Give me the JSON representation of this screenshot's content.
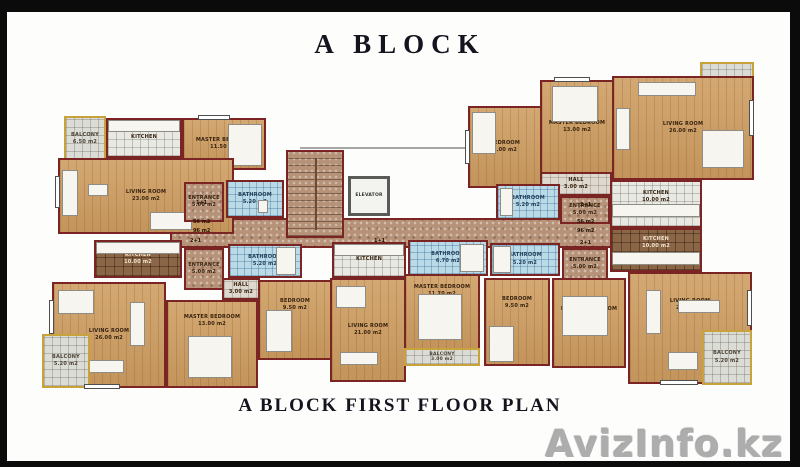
{
  "page": {
    "title": "A BLOCK",
    "caption": "A BLOCK FIRST FLOOR PLAN",
    "watermark": "AvizInfo.kz"
  },
  "colors": {
    "wall": "#7a2424",
    "wood_floor": "#cf9e62",
    "kitchen_tile_light": "#e9e9e3",
    "kitchen_tile_brown": "#8a6546",
    "bathroom_tile": "#badae8",
    "balcony_tile": "#dcdcd6",
    "balcony_rail": "#c8a23b",
    "corridor_marble": "#b69378"
  },
  "core": {
    "elevator": "ELEVATOR",
    "area_labels": [
      "56 m2",
      "96 m2"
    ]
  },
  "unit_types": {
    "one_plus_one": "1+1",
    "two_plus_one": "2+1"
  },
  "rooms": {
    "living_tl": {
      "name": "LIVING ROOM",
      "area": "23.00 m2"
    },
    "master_tl": {
      "name": "MASTER BEDROOM",
      "area": "11.50 m2"
    },
    "kitchen_tl": {
      "name": "KITCHEN",
      "area": ""
    },
    "bathroom_tl": {
      "name": "BATHROOM",
      "area": "5.20 m2"
    },
    "balcony_tl": {
      "name": "BALCONY",
      "area": "6.50 m2"
    },
    "entrance_tl": {
      "name": "ENTRANCE",
      "area": "5.00 m2"
    },
    "living_tr": {
      "name": "LIVING ROOM",
      "area": "26.00 m2"
    },
    "master_tr": {
      "name": "MASTER BEDROOM",
      "area": "13.00 m2"
    },
    "bedroom_tr": {
      "name": "BEDROOM",
      "area": "9.00 m2"
    },
    "kitchen_tr": {
      "name": "KITCHEN",
      "area": "10.00 m2"
    },
    "bathroom_tr": {
      "name": "BATHROOM",
      "area": "5.20 m2"
    },
    "hall_tr": {
      "name": "HALL",
      "area": "3.00 m2"
    },
    "entrance_tr": {
      "name": "ENTRANCE",
      "area": "5.00 m2"
    },
    "balcony_tr": {
      "name": "BALCONY",
      "area": "5.20 m2"
    },
    "living_bl": {
      "name": "LIVING ROOM",
      "area": "26.00 m2"
    },
    "master_bl": {
      "name": "MASTER BEDROOM",
      "area": "13.00 m2"
    },
    "bedroom_bl": {
      "name": "BEDROOM",
      "area": "9.50 m2"
    },
    "kitchen_bl": {
      "name": "KITCHEN",
      "area": "10.00 m2"
    },
    "bathroom_bl": {
      "name": "BATHROOM",
      "area": "5.20 m2"
    },
    "hall_bl": {
      "name": "HALL",
      "area": "3.00 m2"
    },
    "entrance_bl": {
      "name": "ENTRANCE",
      "area": "5.00 m2"
    },
    "balcony_bl": {
      "name": "BALCONY",
      "area": "5.20 m2"
    },
    "living_bc": {
      "name": "LIVING ROOM",
      "area": "21.00 m2"
    },
    "master_bc": {
      "name": "MASTER BEDROOM",
      "area": "11.70 m2"
    },
    "kitchen_bc": {
      "name": "KITCHEN",
      "area": ""
    },
    "bathroom_bc": {
      "name": "BATHROOM",
      "area": "6.70 m2"
    },
    "balcony_bc": {
      "name": "BALCONY",
      "area": "3.00 m2"
    },
    "living_br": {
      "name": "LIVING ROOM",
      "area": "26.00 m2"
    },
    "master_br": {
      "name": "MASTER BEDROOM",
      "area": "13.00 m2"
    },
    "bedroom_br": {
      "name": "BEDROOM",
      "area": "9.50 m2"
    },
    "kitchen_br": {
      "name": "KITCHEN",
      "area": "10.00 m2"
    },
    "bathroom_br": {
      "name": "BATHROOM",
      "area": "5.20 m2"
    },
    "entrance_br": {
      "name": "ENTRANCE",
      "area": "5.00 m2"
    },
    "balcony_br": {
      "name": "BALCONY",
      "area": "5.20 m2"
    }
  }
}
